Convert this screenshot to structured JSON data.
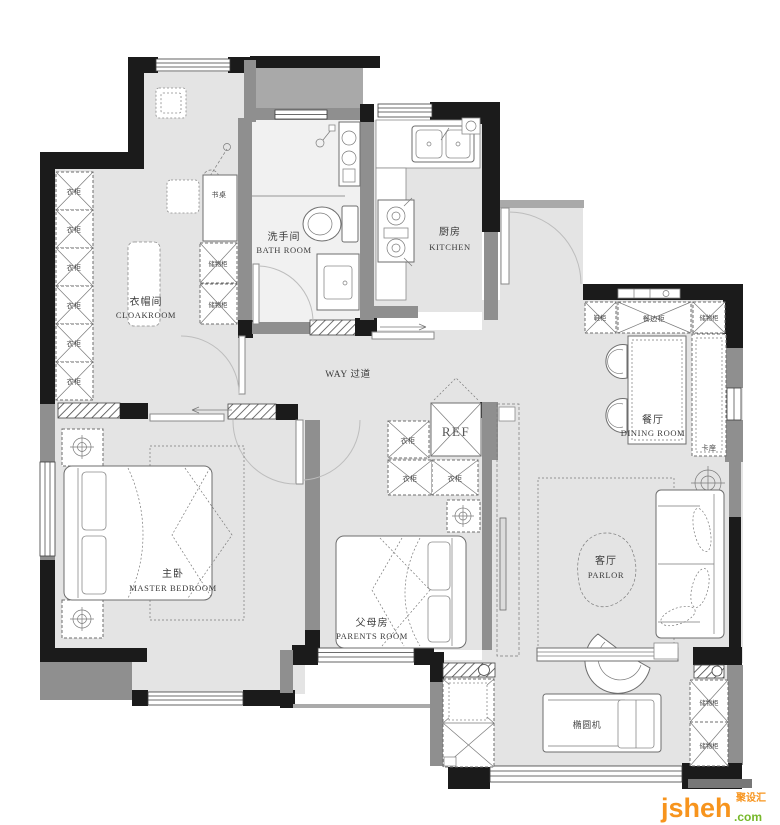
{
  "watermark": {
    "brand": "jsheh",
    "domain": ".com",
    "cn": "聚设汇"
  },
  "rooms": {
    "cloakroom_zh": "衣帽间",
    "cloakroom_en": "CLOAKROOM",
    "bathroom_zh": "洗手间",
    "bathroom_en": "BATH ROOM",
    "kitchen_zh": "厨房",
    "kitchen_en": "KITCHEN",
    "corridor": "WAY 过道",
    "dining_zh": "餐厅",
    "dining_en": "DINING ROOM",
    "master_zh": "主卧",
    "master_en": "MASTER BEDROOM",
    "parents_zh": "父母房",
    "parents_en": "PARENTS ROOM",
    "parlor_zh": "客厅",
    "parlor_en": "PARLOR"
  },
  "furniture": {
    "wardrobe": "衣柜",
    "storage": "储物柜",
    "desk": "书桌",
    "shoe_cabinet": "鞋柜",
    "sideboard": "餐边柜",
    "booth": "卡座",
    "fridge": "REF",
    "elliptical": "椭圆机"
  },
  "colors": {
    "wall": "#1b1b1b",
    "secondary_wall": "#8f8f8f",
    "floor": "#e4e4e4",
    "watermark_orange": "#F7941D",
    "watermark_green": "#76B82A"
  }
}
